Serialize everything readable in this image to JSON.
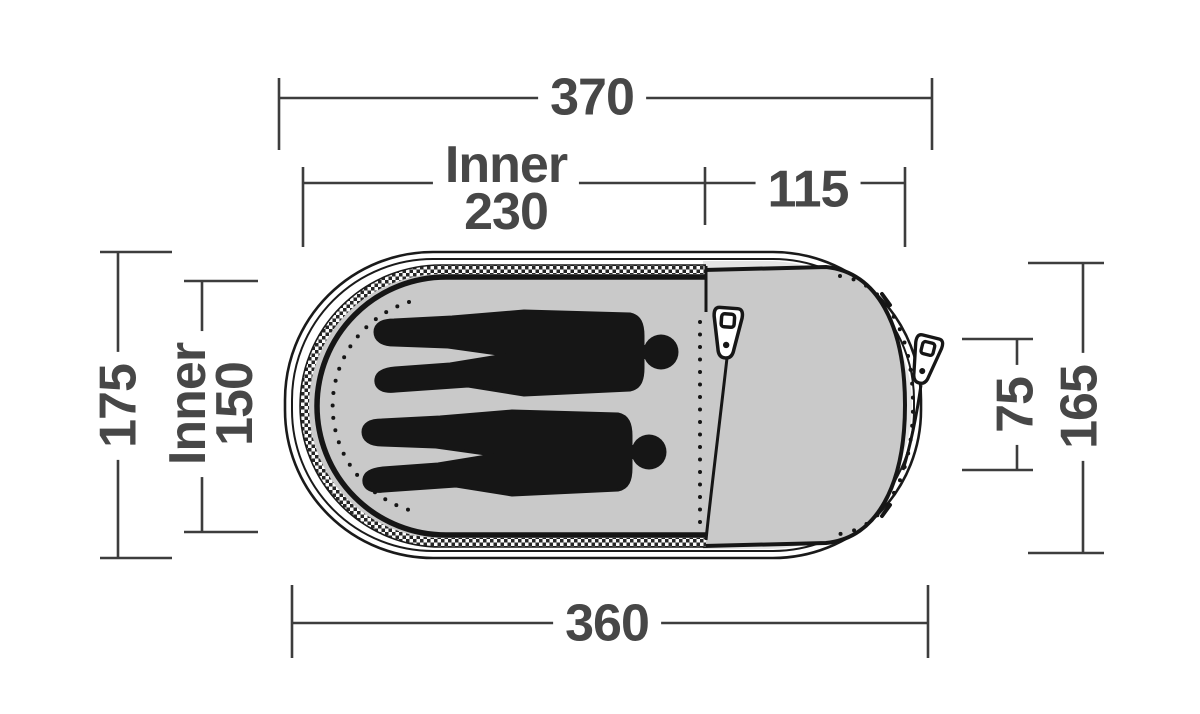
{
  "title": "Tent floor plan top view with dimensions",
  "colors": {
    "ink": "#1a1a1a",
    "dim_line": "#3d3d3d",
    "label_text": "#474747",
    "inner_floor": "#c9c9c9",
    "vestibule_floor": "#c9c9c9",
    "vestibule_outer_zone": "#e4e4e4",
    "background": "#ffffff",
    "silhouette": "#161616"
  },
  "dimensions": {
    "top_total": {
      "value": "370"
    },
    "inner_width": {
      "prefix": "Inner",
      "value": "230"
    },
    "porch_width": {
      "value": "115"
    },
    "left_outer_depth": {
      "value": "175"
    },
    "inner_depth": {
      "prefix": "Inner",
      "value": "150"
    },
    "porch_door_width": {
      "value": "75"
    },
    "right_outer_depth": {
      "value": "165"
    },
    "bottom_total": {
      "value": "360"
    }
  },
  "tent": {
    "occupant_silhouettes": 2,
    "zipper_pulls": 2,
    "areas": [
      "inner-tent",
      "porch"
    ]
  }
}
